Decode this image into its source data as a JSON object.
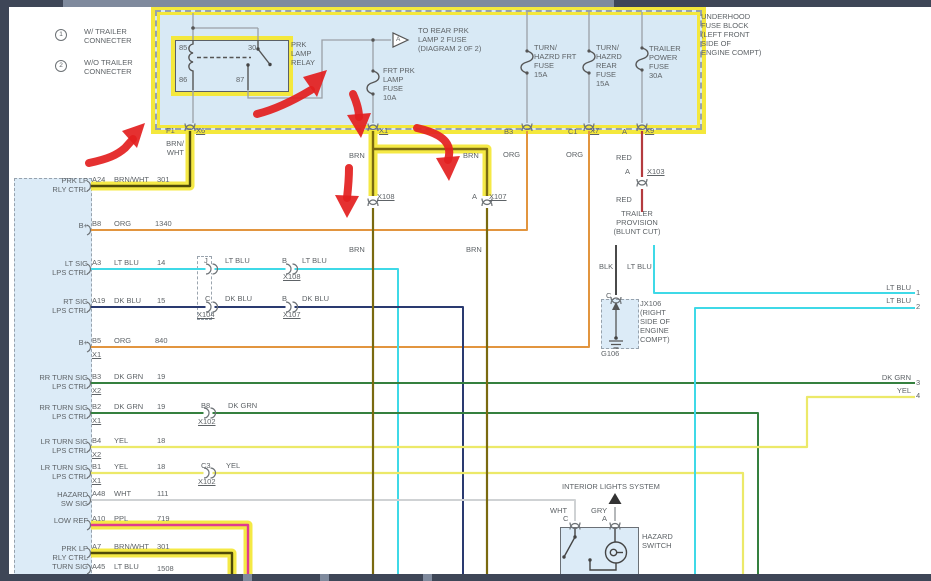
{
  "colors": {
    "highlight_yellow": "#f4e83c",
    "marker_red": "#e31f1f",
    "block_fill": "#d8e9f5",
    "chrome_bar": "#3e4657",
    "wire_hex": {
      "BRN": "#7a6a10",
      "BRN/WHT": "#4f4a08",
      "ORG": "#e2953f",
      "LT BLU": "#3fd9e7",
      "DK BLU": "#2a3a70",
      "DK GRN": "#35803f",
      "YEL": "#ece969",
      "WHT": "#cfd2d4",
      "PPL": "#e03a90",
      "RED": "#b43b3f",
      "BLK": "#4a4a4a",
      "GRY": "#b5b8ba"
    }
  },
  "legend": {
    "item1_num": "1",
    "item1_label": "W/ TRAILER\nCONNECTER",
    "item2_num": "2",
    "item2_label": "W/O TRAILER\nCONNECTER"
  },
  "fuse_block": {
    "title": "UNDERHOOD\nFUSE BLOCK\n(LEFT FRONT\nSIDE OF\nENGINE COMPT)",
    "relay_label": "PRK\nLAMP\nRELAY",
    "pin85": "85",
    "pin30": "30",
    "pin86": "86",
    "pin87": "87",
    "to_rear": "TO REAR PRK\nLAMP 2 FUSE\n(DIAGRAM 2 0F 2)",
    "triangle_letter": "A",
    "fuse_frt_prk": "FRT PRK\nLAMP\nFUSE\n10A",
    "fuse_turn_frt": "TURN/\nHAZRD FRT\nFUSE\n15A",
    "fuse_turn_rear": "TURN/\nHAZRD\nREAR\nFUSE\n15A",
    "fuse_trailer": "TRAILER\nPOWER\nFUSE\n30A",
    "out_f1": "F1",
    "out_x6": "X6",
    "out_x1": "X1",
    "out_b3": "B3",
    "out_c1": "C1",
    "out_x7": "X7",
    "out_a": "A",
    "out_x9": "X9"
  },
  "module": {
    "rows": [
      {
        "label": "PRK LP\nRLY CTRL",
        "pin": "A24",
        "color": "BRN/WHT",
        "circuit": "301",
        "sub": ""
      },
      {
        "label": "B+",
        "pin": "B8",
        "color": "ORG",
        "circuit": "1340",
        "sub": ""
      },
      {
        "label": "LT SIG\nLPS CTRL",
        "pin": "A3",
        "color": "LT BLU",
        "circuit": "14",
        "sub": ""
      },
      {
        "label": "RT SIG\nLPS CTRL",
        "pin": "A19",
        "color": "DK BLU",
        "circuit": "15",
        "sub": ""
      },
      {
        "label": "B+",
        "pin": "B5",
        "color": "ORG",
        "circuit": "840",
        "sub": "X1"
      },
      {
        "label": "RR TURN SIG\nLPS CTRL",
        "pin": "B3",
        "color": "DK GRN",
        "circuit": "19",
        "sub": "X2"
      },
      {
        "label": "RR TURN SIG\nLPS CTRL",
        "pin": "B2",
        "color": "DK GRN",
        "circuit": "19",
        "sub": "X1"
      },
      {
        "label": "LR TURN SIG\nLPS CTRL",
        "pin": "B4",
        "color": "YEL",
        "circuit": "18",
        "sub": "X2"
      },
      {
        "label": "LR TURN SIG\nLPS CTRL",
        "pin": "B1",
        "color": "YEL",
        "circuit": "18",
        "sub": "X1"
      },
      {
        "label": "HAZARD\nSW SIG",
        "pin": "A48",
        "color": "WHT",
        "circuit": "111",
        "sub": ""
      },
      {
        "label": "LOW REF",
        "pin": "A10",
        "color": "PPL",
        "circuit": "719",
        "sub": ""
      },
      {
        "label": "PRK LP\nRLY CTRL",
        "pin": "A7",
        "color": "BRN/WHT",
        "circuit": "301",
        "sub": ""
      },
      {
        "label": "TURN SIG",
        "pin": "A45",
        "color": "LT BLU",
        "circuit": "1508",
        "sub": ""
      }
    ]
  },
  "inline_labels": {
    "brnwht_vert": "BRN/\nWHT",
    "brn_left_top": "BRN",
    "brn_right_top": "BRN",
    "brn_left_mid": "BRN",
    "brn_right_mid": "BRN",
    "x108_top": "X108",
    "x107_pin": "A",
    "x107_top": "X107",
    "org_left": "ORG",
    "org_right": "ORG",
    "lt_pin_j": "J",
    "lt_color_mid": "LT BLU",
    "lt_pin_b": "B",
    "lt_x108": "X108",
    "lt_color_after": "LT BLU",
    "dk_pin_c": "C",
    "dk_x104": "X104",
    "dk_color_mid": "DK BLU",
    "dk_pin_b": "B",
    "dk_x107": "X107",
    "dk_color_after": "DK BLU",
    "grn_pin_b8": "B8",
    "grn_x102": "X102",
    "grn_color_after": "DK GRN",
    "yel_pin_c3": "C3",
    "yel_x102": "X102",
    "yel_color_after": "YEL"
  },
  "trailer": {
    "red_upper": "RED",
    "x103_pin": "A",
    "x103": "X103",
    "red_lower": "RED",
    "provision": "TRAILER\nPROVISION\n(BLUNT CUT)",
    "blk": "BLK",
    "lt_blu": "LT BLU",
    "jx_pin": "C",
    "jx106": "JX106\n(RIGHT\nSIDE OF\nENGINE\nCOMPT)",
    "g106": "G106"
  },
  "right_exits": [
    {
      "label": "LT BLU",
      "num": "1"
    },
    {
      "label": "LT BLU",
      "num": "2"
    },
    {
      "label": "DK GRN",
      "num": "3"
    },
    {
      "label": "YEL",
      "num": "4"
    }
  ],
  "hazard": {
    "interior": "INTERIOR LIGHTS SYSTEM",
    "wht": "WHT",
    "gry": "GRY",
    "pin_c": "C",
    "pin_a": "A",
    "switch_label": "HAZARD\nSWITCH"
  }
}
